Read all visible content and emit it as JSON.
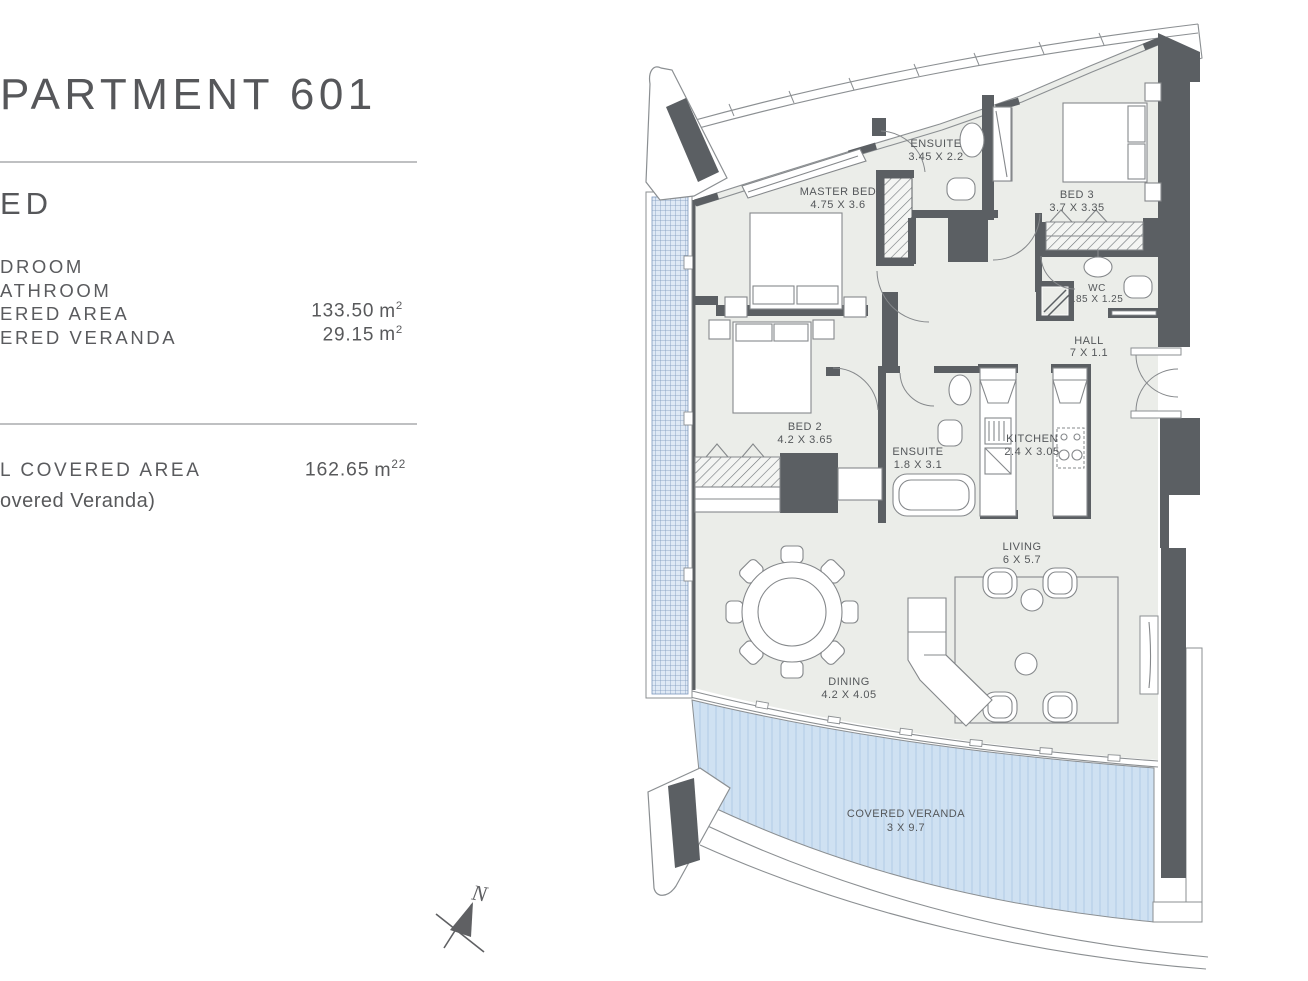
{
  "panel": {
    "title": "PARTMENT 601",
    "subtitle": "ED",
    "items": [
      {
        "label": "DROOM",
        "value": "",
        "unit": "",
        "sup": ""
      },
      {
        "label": "ATHROOM",
        "value": "",
        "unit": "",
        "sup": ""
      },
      {
        "label": "ERED AREA",
        "value": "133.50",
        "unit": "m",
        "sup": "2"
      },
      {
        "label": "ERED VERANDA",
        "value": "29.15",
        "unit": "m",
        "sup": "2"
      }
    ],
    "total": {
      "label": "L COVERED AREA",
      "value": "162.65",
      "unit": "m",
      "sup": "22",
      "note": "overed Veranda)"
    }
  },
  "plan": {
    "rooms": [
      {
        "name": "ENSUITE",
        "dims": "3.45 X 2.2"
      },
      {
        "name": "MASTER BED",
        "dims": "4.75 X 3.6"
      },
      {
        "name": "BED 3",
        "dims": "3.7 X 3.35"
      },
      {
        "name": "WC",
        "dims": ".85 X 1.25"
      },
      {
        "name": "HALL",
        "dims": "7 X 1.1"
      },
      {
        "name": "BED 2",
        "dims": "4.2 X 3.65"
      },
      {
        "name": "ENSUITE",
        "dims": "1.8 X 3.1"
      },
      {
        "name": "KITCHEN",
        "dims": "2.4 X 3.05"
      },
      {
        "name": "LIVING",
        "dims": "6 X 5.7"
      },
      {
        "name": "DINING",
        "dims": "4.2 X 4.05"
      },
      {
        "name": "COVERED VERANDA",
        "dims": "3 X 9.7"
      }
    ],
    "compass": {
      "label": "N"
    },
    "colors": {
      "wall": "#5b5f63",
      "floor": "#ebede9",
      "veranda_fill": "#cfe1f2",
      "veranda_stripe": "#bdd3ea",
      "screen_fill": "#dfe9f5",
      "screen_line": "#7b97bb",
      "outline": "#8b8f92",
      "label_text": "#54575a",
      "panel_text": "#58595b"
    }
  }
}
